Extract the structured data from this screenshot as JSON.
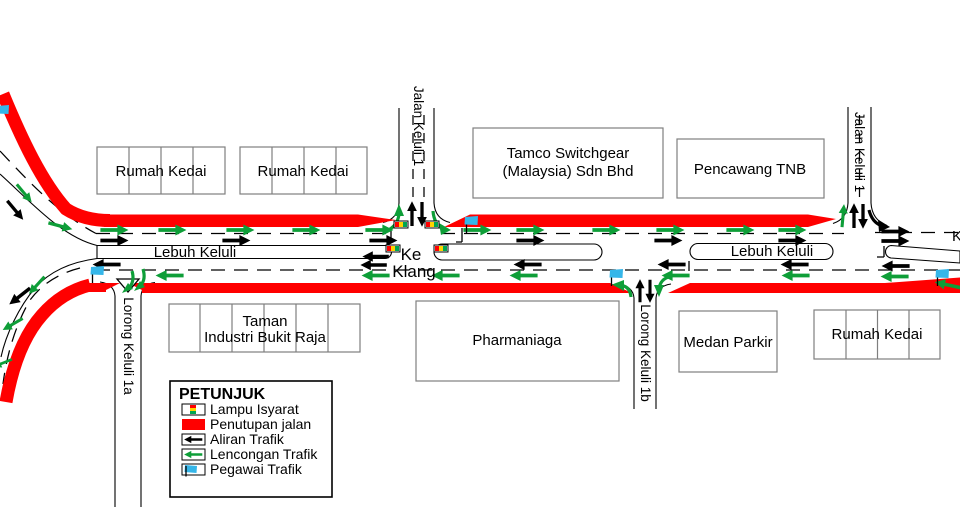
{
  "colors": {
    "closure": "#FF0000",
    "diversion": "#0E9E38",
    "flow": "#000000",
    "officer": "#35B6E9",
    "signal_red": "#FF0000",
    "signal_yellow": "#FFD400",
    "signal_green": "#00A651",
    "building_border": "#7F7F7F"
  },
  "buildings": {
    "rumah_kedai_nw": "Rumah Kedai",
    "rumah_kedai_n": "Rumah Kedai",
    "tamco_line1": "Tamco Switchgear",
    "tamco_line2": "(Malaysia) Sdn Bhd",
    "pencawang": "Pencawang TNB",
    "taman_line1": "Taman",
    "taman_line2": "Industri Bukit Raja",
    "pharmaniaga": "Pharmaniaga",
    "medan_parkir": "Medan Parkir",
    "rumah_kedai_se": "Rumah Kedai"
  },
  "roads": {
    "lebuh_keluli_west": "Lebuh Keluli",
    "lebuh_keluli_east": "Lebuh Keluli",
    "jalan_keluli_1_west": "Jalan Keluli 1",
    "jalan_keluli_1_east": "Jalan Keluli 1",
    "lorong_keluli_1a": "Lorong Keluli 1a",
    "lorong_keluli_1b": "Lorong Keluli 1b",
    "ke_klang_line1": "Ke",
    "ke_klang_line2": "Klang",
    "edge_label": "K"
  },
  "legend": {
    "title": "PETUNJUK",
    "items": [
      {
        "icon": "traffic-light-icon",
        "label": "Lampu Isyarat"
      },
      {
        "icon": "road-closure-swatch",
        "label": "Penutupan jalan"
      },
      {
        "icon": "traffic-flow-arrow-icon",
        "label": "Aliran Trafik"
      },
      {
        "icon": "diversion-arrow-icon",
        "label": "Lencongan Trafik"
      },
      {
        "icon": "traffic-officer-icon",
        "label": "Pegawai Trafik"
      }
    ]
  }
}
